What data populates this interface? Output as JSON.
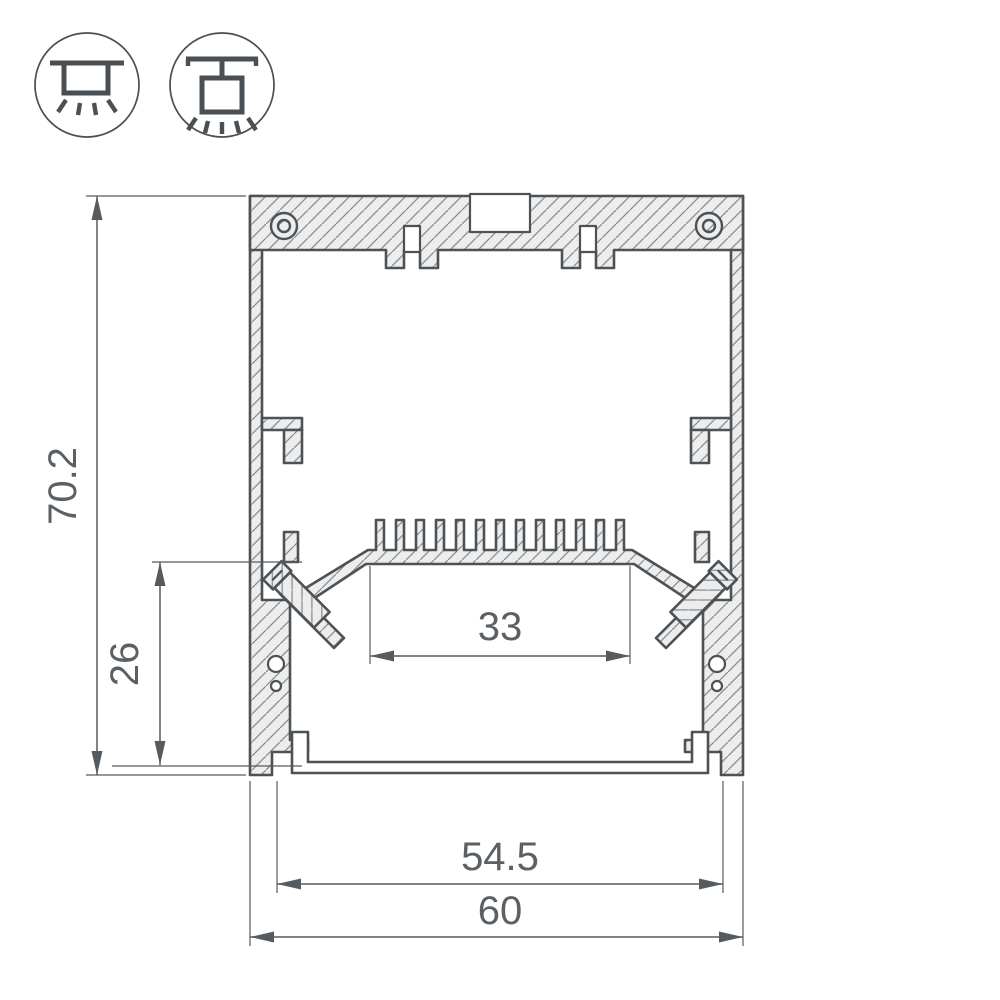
{
  "drawing": {
    "type": "led-profile-cross-section",
    "dimensions": {
      "overall_height": "70.2",
      "base_height": "26",
      "led_platform_width": "33",
      "inner_width": "54.5",
      "overall_width": "60"
    },
    "icons": [
      {
        "name": "surface-mount-luminaire-icon",
        "meaning": "surface mounted"
      },
      {
        "name": "pendant-mount-luminaire-icon",
        "meaning": "suspended / pendant mounted"
      }
    ],
    "colors": {
      "outline": "#4d5256",
      "fill": "#ededed",
      "hatch": "#888e92",
      "dimension": "#565b5f",
      "text": "#5a6064",
      "background": "#ffffff"
    }
  }
}
